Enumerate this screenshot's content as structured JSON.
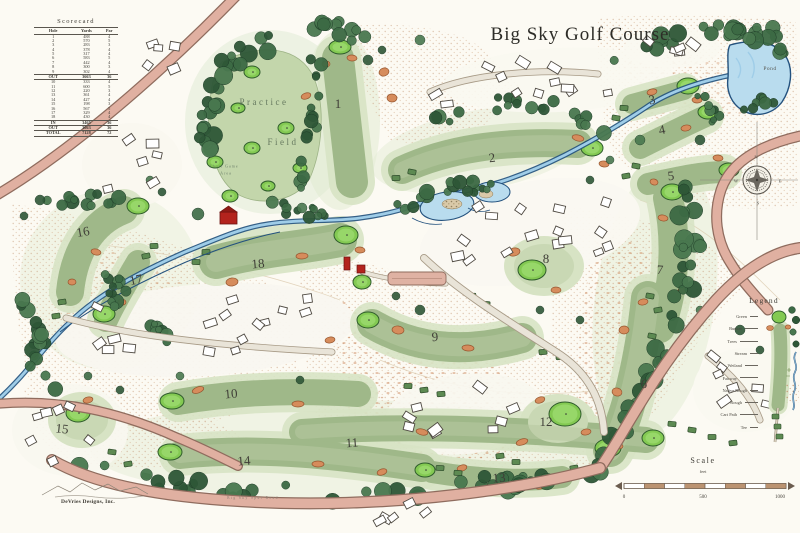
{
  "title": "Big Sky Golf Course",
  "scorecard": {
    "title": "Scorecard",
    "columns": [
      "Hole",
      "Yards",
      "Par"
    ],
    "rows": [
      [
        "1",
        "488",
        "4"
      ],
      [
        "2",
        "570",
        "5"
      ],
      [
        "3",
        "283",
        "3"
      ],
      [
        "4",
        "378",
        "4"
      ],
      [
        "5",
        "317",
        "4"
      ],
      [
        "6",
        "583",
        "5"
      ],
      [
        "7",
        "442",
        "4"
      ],
      [
        "8",
        "300",
        "3"
      ],
      [
        "9",
        "302",
        "4"
      ],
      [
        "OUT",
        "3663",
        "36"
      ],
      [
        "10",
        "333",
        "4"
      ],
      [
        "11",
        "600",
        "5"
      ],
      [
        "12",
        "220",
        "3"
      ],
      [
        "13",
        "361",
        "4"
      ],
      [
        "14",
        "427",
        "4"
      ],
      [
        "15",
        "198",
        "3"
      ],
      [
        "16",
        "567",
        "5"
      ],
      [
        "17",
        "329",
        "4"
      ],
      [
        "18",
        "430",
        "4"
      ],
      [
        "IN",
        "3465",
        "36"
      ],
      [
        "OUT",
        "3663",
        "36"
      ],
      [
        "TOTAL",
        "7128",
        "72"
      ]
    ]
  },
  "holes": [
    {
      "n": "1",
      "x": 338,
      "y": 104,
      "r": 0
    },
    {
      "n": "2",
      "x": 492,
      "y": 158,
      "r": -8
    },
    {
      "n": "3",
      "x": 652,
      "y": 100,
      "r": -10
    },
    {
      "n": "4",
      "x": 662,
      "y": 130,
      "r": -12
    },
    {
      "n": "5",
      "x": 671,
      "y": 176,
      "r": -6
    },
    {
      "n": "6",
      "x": 644,
      "y": 384,
      "r": 8
    },
    {
      "n": "7",
      "x": 660,
      "y": 270,
      "r": 4
    },
    {
      "n": "8",
      "x": 546,
      "y": 259,
      "r": 0
    },
    {
      "n": "9",
      "x": 435,
      "y": 337,
      "r": -4
    },
    {
      "n": "10",
      "x": 231,
      "y": 394,
      "r": -5
    },
    {
      "n": "11",
      "x": 352,
      "y": 443,
      "r": -4
    },
    {
      "n": "12",
      "x": 546,
      "y": 422,
      "r": 0
    },
    {
      "n": "13",
      "x": 499,
      "y": 478,
      "r": -3
    },
    {
      "n": "14",
      "x": 244,
      "y": 461,
      "r": -4
    },
    {
      "n": "15",
      "x": 62,
      "y": 429,
      "r": 6
    },
    {
      "n": "16",
      "x": 83,
      "y": 232,
      "r": -10
    },
    {
      "n": "17",
      "x": 136,
      "y": 280,
      "r": -12
    },
    {
      "n": "18",
      "x": 258,
      "y": 264,
      "r": -5
    }
  ],
  "map_labels": [
    {
      "text": "Practice",
      "x": 264,
      "y": 102,
      "cls": "lbl-practice",
      "name": "practice-label"
    },
    {
      "text": "Field",
      "x": 283,
      "y": 142,
      "cls": "lbl-practice",
      "name": "field-label"
    },
    {
      "text": "Pond",
      "x": 770,
      "y": 69,
      "cls": "lbl-pond",
      "name": "pond-label"
    },
    {
      "text": "Short Game",
      "x": 224,
      "y": 166,
      "cls": "lbl-tiny-green",
      "name": "short-game-label"
    },
    {
      "text": "Area",
      "x": 226,
      "y": 173,
      "cls": "lbl-tiny-green",
      "name": "short-game-area-label"
    },
    {
      "text": "Big Sky Spur Road",
      "x": 253,
      "y": 498,
      "cls": "lbl-road",
      "name": "road-label"
    },
    {
      "text": "N",
      "x": 756,
      "y": 157,
      "cls": "lbl-compass",
      "name": "compass-n"
    },
    {
      "text": "E",
      "x": 780,
      "y": 181,
      "cls": "lbl-compass",
      "name": "compass-e"
    },
    {
      "text": "S",
      "x": 758,
      "y": 203,
      "cls": "lbl-compass",
      "name": "compass-s"
    },
    {
      "text": "W",
      "x": 736,
      "y": 181,
      "cls": "lbl-compass",
      "name": "compass-w"
    }
  ],
  "legend": {
    "title": "Legend",
    "items": [
      "Green",
      "Bunker",
      "Trees",
      "Stream",
      "Wetland",
      "Fairway",
      "Native Rough",
      "Rough",
      "Cart Path",
      "Tee"
    ]
  },
  "scale": {
    "title": "Scale",
    "unit": "feet",
    "ticks": [
      "0",
      "500",
      "1000"
    ]
  },
  "credit": "DeVries Designs, Inc."
}
